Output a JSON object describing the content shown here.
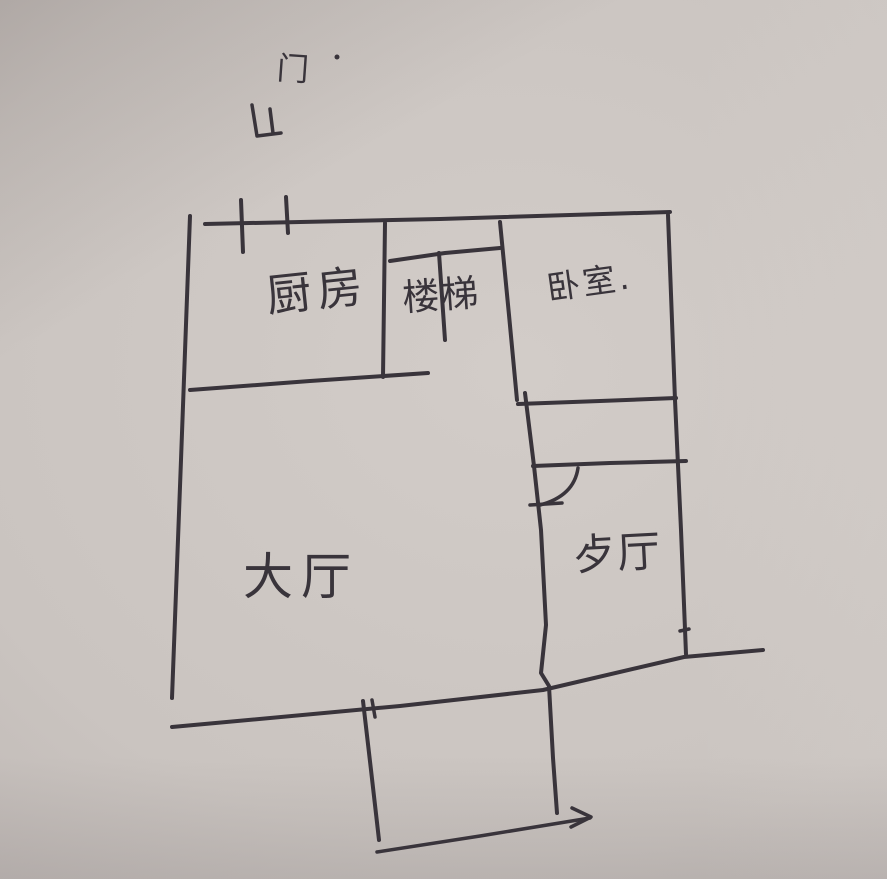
{
  "paper": {
    "background_color": "#cac4c0",
    "ink_color": "#39343b"
  },
  "labels": {
    "door": {
      "text": "门"
    },
    "kitchen": {
      "text": "厨房"
    },
    "stairs": {
      "text": "楼梯"
    },
    "bedroom": {
      "text": "卧室."
    },
    "hall": {
      "text": "大厅"
    },
    "dining": {
      "text": "歺厅"
    }
  },
  "sketch": {
    "stroke_color": "#39343b",
    "strokes": [
      {
        "name": "top-wall",
        "width": 4,
        "points": [
          [
            205,
            224
          ],
          [
            440,
            219
          ],
          [
            670,
            212
          ]
        ]
      },
      {
        "name": "left-wall",
        "width": 4,
        "points": [
          [
            190,
            216
          ],
          [
            181,
            460
          ],
          [
            172,
            698
          ]
        ]
      },
      {
        "name": "right-wall",
        "width": 4,
        "points": [
          [
            668,
            215
          ],
          [
            675,
            400
          ],
          [
            681,
            530
          ],
          [
            686,
            654
          ]
        ]
      },
      {
        "name": "bottom-wall",
        "width": 4,
        "points": [
          [
            172,
            727
          ],
          [
            400,
            706
          ],
          [
            543,
            690
          ],
          [
            684,
            657
          ],
          [
            763,
            650
          ]
        ]
      },
      {
        "name": "kitchen-stairs-divider",
        "width": 4,
        "points": [
          [
            385,
            223
          ],
          [
            383,
            377
          ]
        ]
      },
      {
        "name": "kitchen-bottom-wall",
        "width": 4,
        "points": [
          [
            190,
            390
          ],
          [
            310,
            381
          ],
          [
            428,
            373
          ]
        ]
      },
      {
        "name": "stairs-bedroom-divider",
        "width": 4,
        "points": [
          [
            500,
            222
          ],
          [
            509,
            315
          ],
          [
            517,
            400
          ]
        ]
      },
      {
        "name": "stairs-rail-horizontal",
        "width": 4,
        "points": [
          [
            390,
            261
          ],
          [
            445,
            253
          ],
          [
            500,
            248
          ]
        ]
      },
      {
        "name": "stairs-rail-stem",
        "width": 4,
        "points": [
          [
            439,
            253
          ],
          [
            445,
            340
          ]
        ]
      },
      {
        "name": "bedroom-bottom-wall",
        "width": 4,
        "points": [
          [
            518,
            404
          ],
          [
            600,
            401
          ],
          [
            676,
            398
          ]
        ]
      },
      {
        "name": "hall-dining-wall",
        "width": 4,
        "points": [
          [
            525,
            393
          ],
          [
            534,
            466
          ],
          [
            541,
            530
          ],
          [
            546,
            625
          ],
          [
            541,
            673
          ],
          [
            549,
            686
          ],
          [
            553,
            758
          ],
          [
            557,
            813
          ]
        ]
      },
      {
        "name": "dining-top-wall",
        "width": 4,
        "points": [
          [
            533,
            466
          ],
          [
            610,
            463
          ],
          [
            686,
            461
          ]
        ]
      },
      {
        "name": "dining-door-leaf",
        "width": 3.5,
        "points": [
          [
            530,
            505
          ],
          [
            562,
            503
          ]
        ]
      },
      {
        "name": "entry-door-tick-1",
        "width": 4,
        "points": [
          [
            241,
            200
          ],
          [
            243,
            252
          ]
        ]
      },
      {
        "name": "entry-door-tick-2",
        "width": 4,
        "points": [
          [
            286,
            197
          ],
          [
            288,
            233
          ]
        ]
      },
      {
        "name": "door-swing-symbol-a",
        "width": 3.5,
        "points": [
          [
            252,
            105
          ],
          [
            257,
            136
          ],
          [
            281,
            133
          ]
        ]
      },
      {
        "name": "door-swing-symbol-b",
        "width": 3.5,
        "points": [
          [
            270,
            109
          ],
          [
            273,
            133
          ]
        ]
      },
      {
        "name": "porch-left-wall",
        "width": 4,
        "points": [
          [
            363,
            701
          ],
          [
            371,
            770
          ],
          [
            379,
            840
          ]
        ]
      },
      {
        "name": "porch-wall-tick",
        "width": 3.5,
        "points": [
          [
            372,
            700
          ],
          [
            375,
            717
          ]
        ]
      },
      {
        "name": "right-wall-door-tick",
        "width": 3.5,
        "points": [
          [
            680,
            631
          ],
          [
            689,
            629
          ]
        ]
      },
      {
        "name": "entrance-arrow-line",
        "width": 3.5,
        "points": [
          [
            377,
            852
          ],
          [
            480,
            836
          ],
          [
            590,
            818
          ]
        ]
      },
      {
        "name": "entrance-arrow-head",
        "width": 3.5,
        "points": [
          [
            572,
            808
          ],
          [
            591,
            817
          ],
          [
            571,
            827
          ]
        ]
      }
    ],
    "curves": [
      {
        "name": "dining-door-arc",
        "width": 3.5,
        "d": "M578,468 Q574,496 540,505"
      }
    ],
    "dots": [
      {
        "name": "ink-dot-near-door-label",
        "cx": 337,
        "cy": 57,
        "r": 2.5
      }
    ]
  }
}
